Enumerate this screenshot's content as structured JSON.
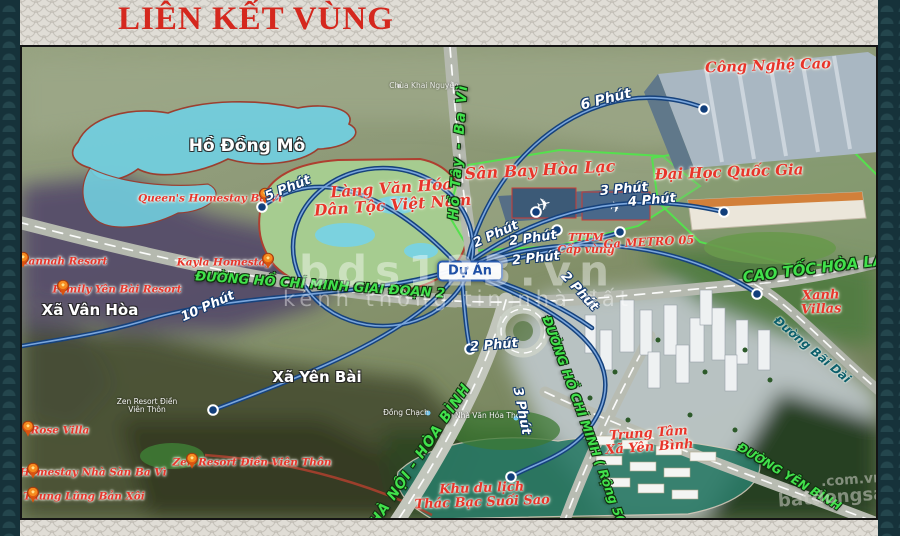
{
  "header": {
    "title": "LIÊN KẾT VÙNG"
  },
  "project": {
    "label": "Dự Án"
  },
  "watermarks": {
    "brand": "bds123.vn",
    "tagline": "kênh thông tin nhà đất",
    "corner_top": ".com.vn",
    "corner_bottom": "batdongsan"
  },
  "colors": {
    "accent_red": "#d5281e",
    "route_blue": "#16427c",
    "road_label_green": "#41e14b",
    "lake_cyan": "#72cede"
  },
  "map": {
    "places": {
      "ho_dong_mo": "Hồ Đồng Mô",
      "xa_van_hoa": "Xã Vân Hòa",
      "xa_yen_bai": "Xã Yên Bài",
      "lang_van_hoa": "Làng Văn Hóa\nDân Tộc Việt Nam",
      "san_bay_hoa_lac": "Sân Bay Hòa Lạc",
      "cong_nghe_cao": "Công Nghệ Cao",
      "dai_hoc_quoc_gia": "Đại Học Quốc Gia",
      "tttm_cap_vung": "TTTM\nCấp vùng",
      "ga_metro": "Ga METRO 05",
      "xanh_villas": "Xanh Villas",
      "trung_tam_xa_yen_binh": "Trung Tâm\nXã Yên Bình",
      "khu_du_lich": "Khu du lịch\nThác Bạc Suối Sao",
      "zen_resort_area_small": "Zen Resort Điền\nViên Thôn",
      "dong_chach": "Đồng Chạch",
      "nha_van_hoa_thon": "Nhà Văn Hóa Thôn",
      "chua_khai_nguyen": "Chùa Khai Nguyên"
    },
    "roads": {
      "hcm_gd2": "ĐƯỜNG HỒ CHÍ MINH GIAI ĐOẠN 2",
      "ho_tay_ba_vi": "Hồ Tây - Ba Vì",
      "cao_toc_hoa_lac": "CAO TỐC HÒA LẠC",
      "ha_noi_hoa_binh": "HÀ NỘI - HÒA BÌNH",
      "hcm_rong_50m": "ĐƯỜNG HỒ CHÍ MINH ( Rộng 50m )",
      "duong_yen_binh": "ĐƯỜNG YÊN BÌNH",
      "duong_bai_dai": "Đường Bãi Dài"
    },
    "resorts": {
      "queens": "Queen's Homestay Ba Vì",
      "hannah": "Hannah Resort",
      "family_yen_bai": "Family Yên Bài Resort",
      "kayla": "Kayla Homestay",
      "rose_villa": "Rose Villa",
      "homestay_nha_san": "Homestay Nhà Sàn Ba Vì",
      "thung_lung_ban_xoi": "Thung Lũng Bản Xôi",
      "zen_resort": "Zen Resort Điền Viên Thôn"
    },
    "times": {
      "two": "2 Phút",
      "three": "3 Phút",
      "four": "4 Phút",
      "five": "5 Phút",
      "six": "6 Phút",
      "ten": "10 Phút"
    }
  }
}
